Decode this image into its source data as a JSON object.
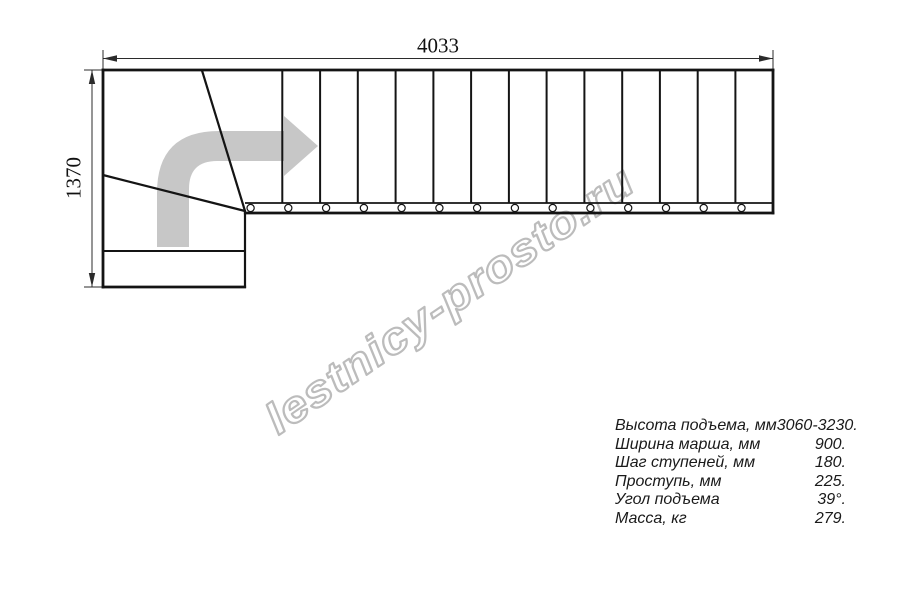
{
  "title": "Stair plan technical drawing",
  "dimensions": {
    "width": {
      "value": "4033"
    },
    "height": {
      "value": "1370"
    }
  },
  "watermark": {
    "text": "lestnicy-prosto.ru"
  },
  "plan": {
    "straight_treads": 14,
    "winder_treads": 3,
    "baluster_circles": 14,
    "direction": "turn-right-then-straight"
  },
  "specs": {
    "rows": [
      {
        "label": "Высота подъема, мм",
        "value": "3060-3230."
      },
      {
        "label": "Ширина марша, мм",
        "value": "900."
      },
      {
        "label": "Шаг ступеней, мм",
        "value": "180."
      },
      {
        "label": "Проступь, мм",
        "value": "225."
      },
      {
        "label": "Угол подъема",
        "value": "39°."
      },
      {
        "label": "Масса, кг",
        "value": "279."
      }
    ]
  },
  "colors": {
    "line": "#141414",
    "dimension": "#2b2b2b",
    "direction_arrow": "#c7c7c7",
    "watermark": "#bcbcbc",
    "background": "#ffffff"
  }
}
